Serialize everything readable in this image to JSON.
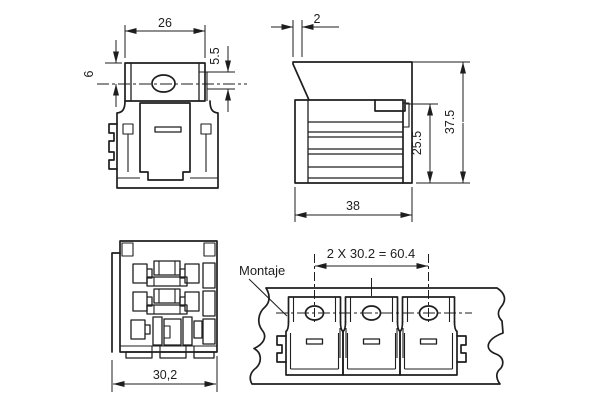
{
  "drawing": {
    "background": "#ffffff",
    "line_color": "#1e1e1e",
    "front_view": {
      "dim_width": "26",
      "dim_left_offset": "6",
      "dim_right_offset": "5.5"
    },
    "side_view": {
      "dim_tab_offset": "2",
      "dim_inner_height": "25.5",
      "dim_total_height": "37.5",
      "dim_depth": "38"
    },
    "bottom_view": {
      "dim_width": "30,2"
    },
    "mounting_view": {
      "label": "Montaje",
      "dim_spacing": "2 X 30.2 = 60.4"
    }
  }
}
